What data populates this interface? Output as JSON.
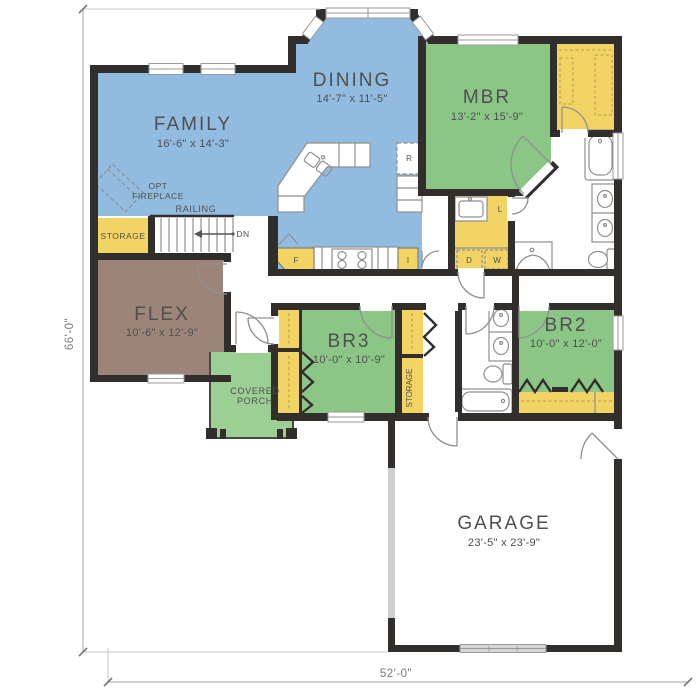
{
  "colors": {
    "living": "#92bcdf",
    "bed": "#8cc687",
    "porch": "#9bcf94",
    "closet": "#f2d465",
    "flex": "#9c8478",
    "wall": "#322e2b",
    "fixture": "#8f8f8f",
    "dim": "#b5b5b5",
    "label": "#4f4f4f",
    "gdoor": "#d6d6d6"
  },
  "plan": {
    "rooms": {
      "family": {
        "name": "FAMILY",
        "dims": "16'-6\" x 14'-3\""
      },
      "dining": {
        "name": "DINING",
        "dims": "14'-7\" x 11'-5\""
      },
      "mbr": {
        "name": "MBR",
        "dims": "13'-2\" x 15'-9\""
      },
      "flex": {
        "name": "FLEX",
        "dims": "10'-6\" x 12'-9\""
      },
      "br3": {
        "name": "BR3",
        "dims": "10'-0\" x 10'-9\""
      },
      "br2": {
        "name": "BR2",
        "dims": "10'-0\" x 12'-0\""
      },
      "garage": {
        "name": "GARAGE",
        "dims": "23'-5\" x 23'-9\""
      },
      "porch": {
        "line1": "COVERED",
        "line2": "PORCH"
      },
      "storage_understairs": {
        "name": "STORAGE"
      },
      "storage_hall": {
        "name": "STORAGE"
      }
    },
    "annotations": {
      "opt_fireplace": {
        "line1": "OPT",
        "line2": "FIREPLACE"
      },
      "railing": "RAILING",
      "stairs_down": "DN",
      "dryer": "D",
      "washer": "W",
      "linen": "L",
      "refrigerator": "R",
      "pantry_left": "F",
      "pantry_right": "I"
    },
    "dimensions": {
      "overall_depth": "66'-0\"",
      "overall_width": "52'-0\""
    }
  }
}
